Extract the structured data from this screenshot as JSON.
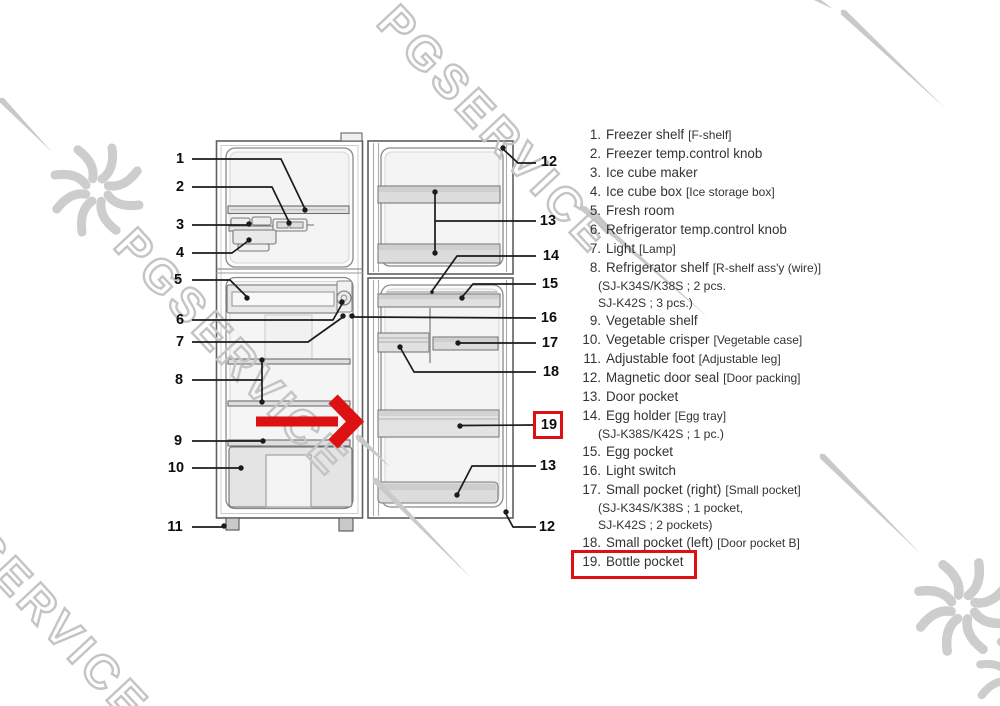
{
  "watermark": {
    "text": "PGSERVICE"
  },
  "diagram": {
    "callouts_left": [
      "1",
      "2",
      "3",
      "4",
      "5",
      "6",
      "7",
      "8",
      "9",
      "10",
      "11"
    ],
    "callouts_right": [
      "12",
      "13",
      "14",
      "15",
      "16",
      "17",
      "18",
      "19",
      "13",
      "12"
    ],
    "highlighted_callout": "19"
  },
  "parts_list": {
    "items": [
      {
        "num": "1.",
        "name": "Freezer shelf",
        "alt": "[F-shelf]",
        "subs": []
      },
      {
        "num": "2.",
        "name": "Freezer temp.control knob",
        "alt": "",
        "subs": []
      },
      {
        "num": "3.",
        "name": "Ice cube maker",
        "alt": "",
        "subs": []
      },
      {
        "num": "4.",
        "name": "Ice cube box",
        "alt": "[Ice storage box]",
        "subs": []
      },
      {
        "num": "5.",
        "name": "Fresh room",
        "alt": "",
        "subs": []
      },
      {
        "num": "6.",
        "name": "Refrigerator temp.control knob",
        "alt": "",
        "subs": []
      },
      {
        "num": "7.",
        "name": "Light",
        "alt": "[Lamp]",
        "subs": []
      },
      {
        "num": "8.",
        "name": "Refrigerator shelf",
        "alt": "[R-shelf ass'y (wire)]",
        "subs": [
          "(SJ-K34S/K38S ; 2 pcs.",
          "SJ-K42S ; 3 pcs.)"
        ]
      },
      {
        "num": "9.",
        "name": "Vegetable shelf",
        "alt": "",
        "subs": []
      },
      {
        "num": "10.",
        "name": "Vegetable crisper",
        "alt": "[Vegetable case]",
        "subs": []
      },
      {
        "num": "11.",
        "name": "Adjustable foot",
        "alt": "[Adjustable leg]",
        "subs": []
      },
      {
        "num": "12.",
        "name": "Magnetic door seal",
        "alt": "[Door packing]",
        "subs": []
      },
      {
        "num": "13.",
        "name": "Door pocket",
        "alt": "",
        "subs": []
      },
      {
        "num": "14.",
        "name": "Egg holder",
        "alt": "[Egg tray]",
        "subs": [
          "(SJ-K38S/K42S ; 1 pc.)"
        ]
      },
      {
        "num": "15.",
        "name": "Egg pocket",
        "alt": "",
        "subs": []
      },
      {
        "num": "16.",
        "name": "Light switch",
        "alt": "",
        "subs": []
      },
      {
        "num": "17.",
        "name": "Small pocket (right)",
        "alt": "[Small pocket]",
        "subs": [
          "(SJ-K34S/K38S ; 1 pocket,",
          "SJ-K42S ; 2 pockets)"
        ]
      },
      {
        "num": "18.",
        "name": "Small pocket (left)",
        "alt": "[Door pocket B]",
        "subs": []
      },
      {
        "num": "19.",
        "name": "Bottle pocket",
        "alt": "",
        "subs": [],
        "highlighted": true
      }
    ]
  },
  "colors": {
    "highlight_red": "#dd1111",
    "arrow_red": "#e01111",
    "watermark_gray": "#c6c6c6",
    "line_black": "#1b1b1b",
    "text": "#333333"
  }
}
